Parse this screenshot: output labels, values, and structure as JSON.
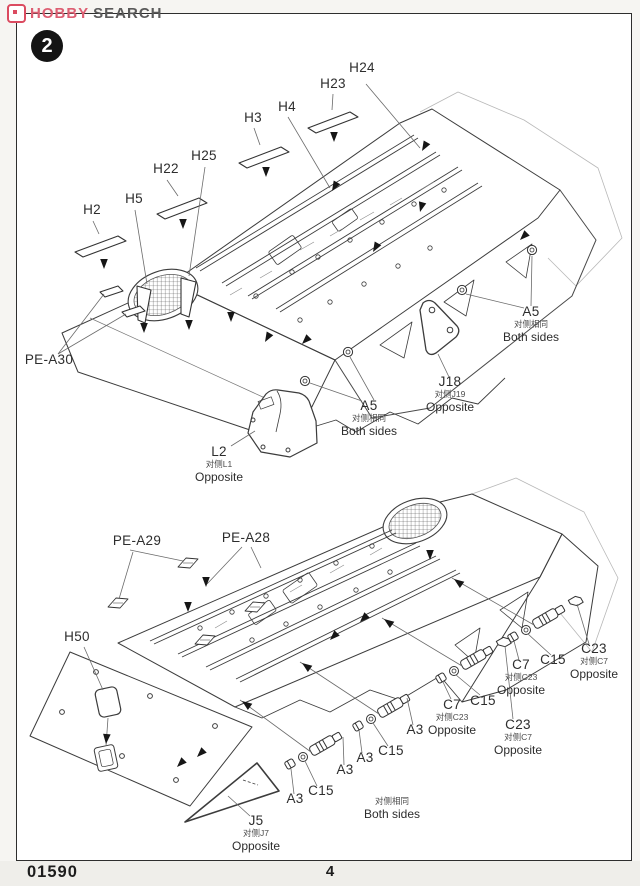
{
  "header": {
    "brand_first": "HOBBY",
    "brand_second": "SEARCH",
    "step_number": "2"
  },
  "footer": {
    "kit_number": "01590",
    "page_number": "4"
  },
  "palette": {
    "brand_red": "#db4b60",
    "line_color": "#3c3c3c",
    "page_bg": "#ffffff"
  },
  "diagrams": {
    "top": {
      "title": "upper-hull-deck-assembly",
      "labels": [
        {
          "part": "H24",
          "x": 362,
          "y": 70
        },
        {
          "part": "H23",
          "x": 333,
          "y": 86
        },
        {
          "part": "H4",
          "x": 287,
          "y": 109
        },
        {
          "part": "H3",
          "x": 253,
          "y": 120
        },
        {
          "part": "H25",
          "x": 204,
          "y": 158
        },
        {
          "part": "H22",
          "x": 166,
          "y": 171
        },
        {
          "part": "H5",
          "x": 134,
          "y": 201
        },
        {
          "part": "H2",
          "x": 92,
          "y": 212
        },
        {
          "part": "PE-A30",
          "x": 49,
          "y": 362
        },
        {
          "part": "A5",
          "cn": "对侧相同",
          "en": "Both sides",
          "x": 531,
          "y": 314
        },
        {
          "part": "J18",
          "cn": "对侧J19",
          "en": "Opposite",
          "x": 450,
          "y": 384
        },
        {
          "part": "A5",
          "cn": "对侧相同",
          "en": "Both sides",
          "x": 369,
          "y": 408
        },
        {
          "part": "L2",
          "cn": "对侧L1",
          "en": "Opposite",
          "x": 219,
          "y": 454
        }
      ]
    },
    "bottom": {
      "title": "lower-hull-suspension-assembly",
      "labels": [
        {
          "part": "PE-A29",
          "x": 137,
          "y": 543
        },
        {
          "part": "PE-A28",
          "x": 246,
          "y": 540
        },
        {
          "part": "H50",
          "x": 77,
          "y": 639
        },
        {
          "part": "C23",
          "cn": "对侧C7",
          "en": "Opposite",
          "x": 594,
          "y": 651
        },
        {
          "part": "C15",
          "x": 553,
          "y": 662
        },
        {
          "part": "C7",
          "cn": "对侧C23",
          "en": "Opposite",
          "x": 521,
          "y": 667
        },
        {
          "part": "C15",
          "x": 483,
          "y": 703
        },
        {
          "part": "C7",
          "cn": "对侧C23",
          "en": "Opposite",
          "x": 452,
          "y": 707
        },
        {
          "part": "C23",
          "cn": "对侧C7",
          "en": "Opposite",
          "x": 518,
          "y": 727
        },
        {
          "part": "A3",
          "x": 415,
          "y": 732
        },
        {
          "part": "C15",
          "x": 391,
          "y": 753
        },
        {
          "part": "A3",
          "x": 365,
          "y": 760
        },
        {
          "part": "A3",
          "x": 345,
          "y": 772
        },
        {
          "part": "C15",
          "x": 321,
          "y": 793
        },
        {
          "part": "A3",
          "x": 295,
          "y": 801
        },
        {
          "part": "",
          "cn": "对侧相同",
          "en": "Both sides",
          "x": 392,
          "y": 806
        },
        {
          "part": "J5",
          "cn": "对侧J7",
          "en": "Opposite",
          "x": 256,
          "y": 823
        }
      ]
    }
  }
}
